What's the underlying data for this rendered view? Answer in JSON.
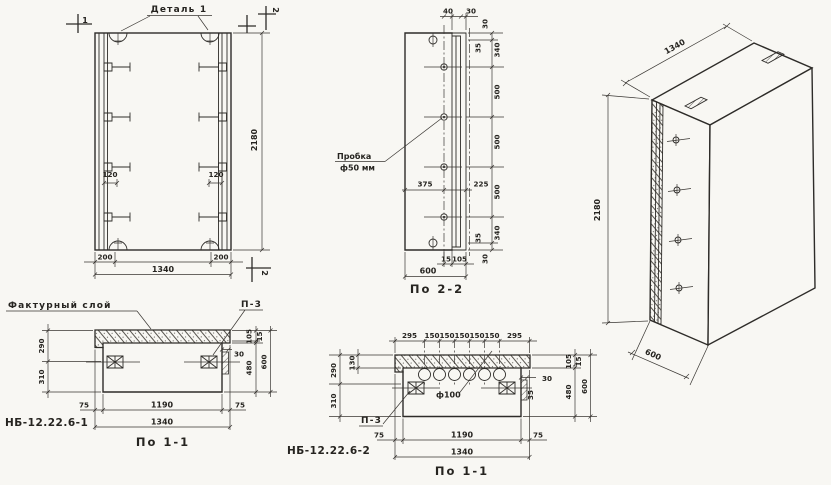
{
  "drawing": {
    "front_view": {
      "detail_label": "Деталь 1",
      "section_mark_top_left": "1",
      "section_mark_top_right": "2",
      "section_mark_bottom_right": "2",
      "dim_height": "2180",
      "dim_edge_left": "200",
      "dim_edge_right": "200",
      "dim_width": "1340",
      "dim_hook_left": "120",
      "dim_hook_right": "120"
    },
    "section_2_2": {
      "title": "По 2-2",
      "plug_label_line1": "Пробка",
      "plug_label_line2": "ф50 мм",
      "dim_top_40": "40",
      "dim_top_30": "30",
      "right_chain": [
        "30",
        "35",
        "340",
        "500",
        "500",
        "500",
        "340",
        "35",
        "30"
      ],
      "dim_375": "375",
      "dim_225": "225",
      "dim_15": "15",
      "dim_105": "105",
      "dim_width": "600"
    },
    "iso_view": {
      "dim_width": "1340",
      "dim_height": "2180",
      "dim_depth": "600"
    },
    "section_1_1_left": {
      "title": "По 1-1",
      "mark": "НБ-12.22.6-1",
      "texture_label": "Фактурный слой",
      "plate_label": "П-3",
      "dim_290": "290",
      "dim_310": "310",
      "dim_105": "105",
      "dim_15": "15",
      "dim_30": "30",
      "dim_480": "480",
      "dim_600": "600",
      "dim_75_left": "75",
      "dim_1190": "1190",
      "dim_75_right": "75",
      "dim_1340": "1340"
    },
    "section_1_1_mid": {
      "title": "По 1-1",
      "mark": "НБ-12.22.6-2",
      "plate_label": "П-3",
      "hole_label": "ф100",
      "top_chain": [
        "295",
        "150",
        "150",
        "150",
        "150",
        "150",
        "295"
      ],
      "dim_130": "130",
      "dim_290": "290",
      "dim_310": "310",
      "dim_30": "30",
      "dim_35": "35",
      "dim_105": "105",
      "dim_15": "15",
      "dim_480": "480",
      "dim_600": "600",
      "dim_75_left": "75",
      "dim_1190": "1190",
      "dim_75_right": "75",
      "dim_1340": "1340"
    }
  }
}
